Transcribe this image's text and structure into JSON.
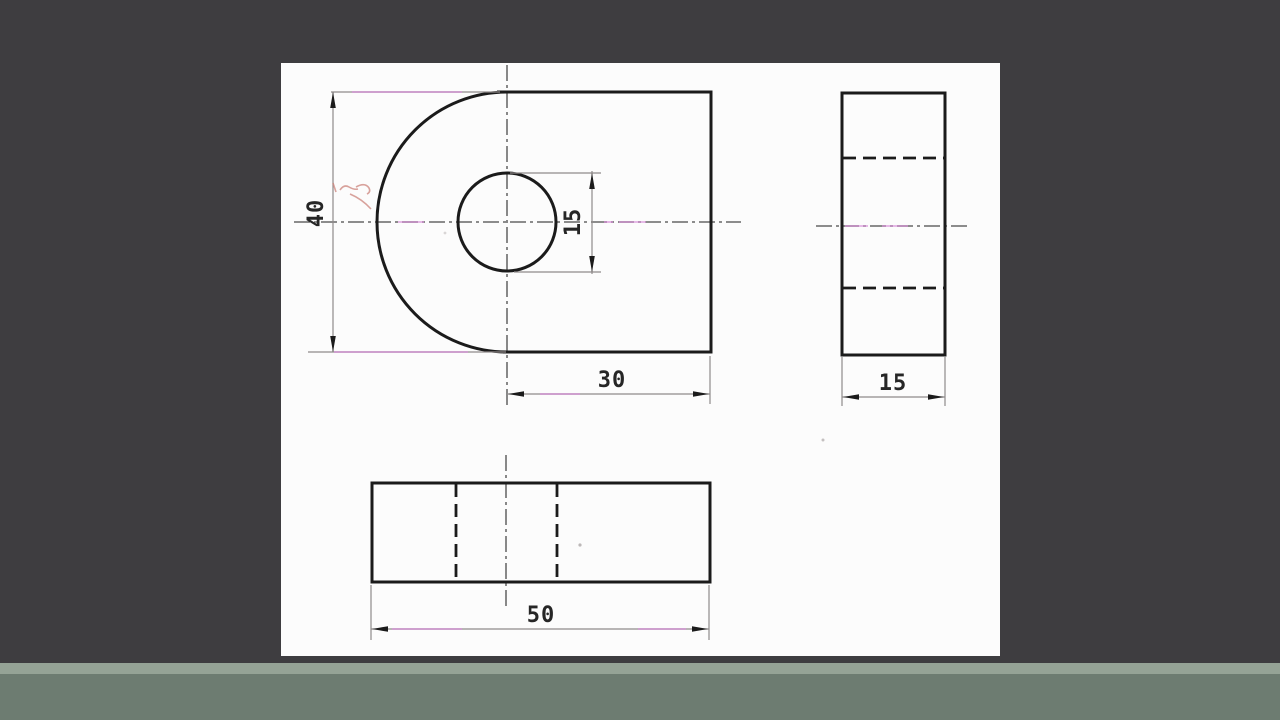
{
  "views": {
    "front": {
      "height": "40",
      "hole_diameter": "15",
      "width_from_center": "30"
    },
    "side": {
      "depth": "15"
    },
    "top": {
      "length": "50"
    }
  },
  "colors": {
    "background": "#3e3d40",
    "paper": "#fcfcfc",
    "band_light": "#95a396",
    "band_dark": "#6d7c71",
    "line": "#1b1b1b",
    "centerline": "#4a4a4a",
    "centerline_accent": "#cf6fd0",
    "annotation_red": "#c97c74"
  }
}
